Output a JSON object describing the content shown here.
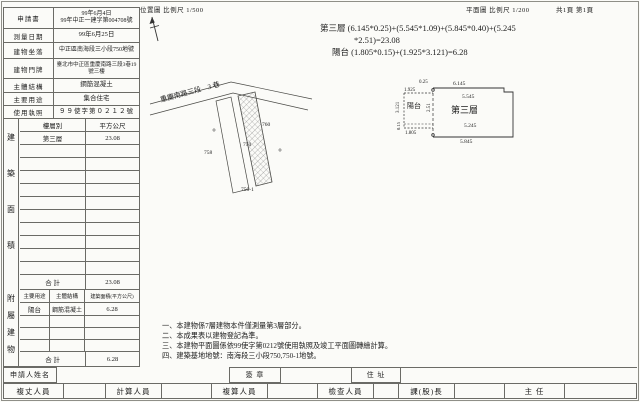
{
  "colors": {
    "paper": "#fbfbf8",
    "ink": "#1c1c1c",
    "line": "#6b6b66"
  },
  "header": {
    "location_scale": "位置圖 比例尺  1/500",
    "plan_scale": "平面圖 比例尺  1/200",
    "pages": "共1頁 第1頁"
  },
  "info": {
    "application_label": "申請書",
    "application_value": "99年6月4日\n99年中正一建字第004708號",
    "survey_date_label": "測量日期",
    "survey_date_value": "99年6月25日",
    "site_label": "建物坐落",
    "site_value": "中正區南海段三小段750地號",
    "address_label": "建物門牌",
    "address_value": "臺北市中正區重慶南路三段3巷19號三樓",
    "structure_label": "主體結構",
    "structure_value": "鋼筋混凝土",
    "use_label": "主要用途",
    "use_value": "集合住宅",
    "license_label": "使用執照",
    "license_value": "９９使字第０２１２號"
  },
  "floor_area": {
    "side_label": "建築面積",
    "col_floor": "樓層別",
    "col_area": "平方公尺",
    "rows": [
      {
        "floor": "第三層",
        "area": "23.08"
      }
    ],
    "total_label": "合  計",
    "total_value": "23.08"
  },
  "annex": {
    "side_label": "附屬建物",
    "col_use": "主要用途",
    "col_structure": "主體結構",
    "col_area": "建築面積(平方公尺)",
    "rows": [
      {
        "use": "陽台",
        "structure": "鋼筋混凝土",
        "area": "6.28"
      }
    ],
    "total_label": "合  計",
    "total_value": "6.28"
  },
  "formulas": {
    "line1": "第三層 (6.145*0.25)+(5.545*1.09)+(5.845*0.40)+(5.245",
    "line2": "*2.51)=23.08",
    "line3": "陽台 (1.805*0.15)+(1.925*3.121)=6.28"
  },
  "location_map": {
    "road_label": "重慶南路三段　3 巷",
    "parcels": [
      "758",
      "750",
      "760",
      "750-1"
    ]
  },
  "floor_plan": {
    "room_label": "第三層",
    "balcony_label": "陽台",
    "dims": {
      "top_strip": "0.25",
      "top": "6.145",
      "balcony_top": "1.925",
      "inner_upper": "5.545",
      "balcony_left": "3.121",
      "mid_height": "2.51",
      "inner_lower": "5.245",
      "strip_height": "0.15",
      "balcony_bottom": "1.805",
      "bottom": "5.845"
    }
  },
  "notes": [
    "一、本建物係7層建物本件僅測量第3層部分。",
    "二、本成果表以建物登記為準。",
    "三、本建物平面圖係依99使字第0212號使用執照及竣工平面圖轉繪計算。",
    "四、建築基地地號：南海段三小段750,750-1地號。"
  ],
  "footer": {
    "applicant_label": "申請人姓名",
    "signature_label": "簽  章",
    "address_label": "住  址",
    "officials": [
      "複丈人員",
      "計算人員",
      "複算人員",
      "檢查人員",
      "課(股)長",
      "主  任"
    ]
  }
}
